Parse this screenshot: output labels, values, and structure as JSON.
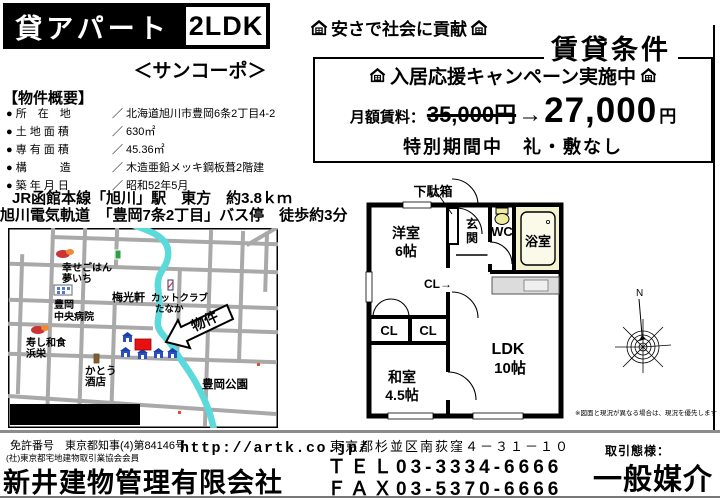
{
  "header": {
    "banner": "貸アパート",
    "unit_type": "2LDK",
    "building_name": "＜サンコーポ＞",
    "slogan": "安さで社会に貢献",
    "conditions_title": "賃貸条件"
  },
  "overview": {
    "section_title": "【物件概要】",
    "rows": [
      {
        "label": "● 所　在　地",
        "value": "／ 北海道旭川市豊岡6条2丁目4-2"
      },
      {
        "label": "● 土 地 面 積",
        "value": "／ 630㎡"
      },
      {
        "label": "● 専 有 面 積",
        "value": "／ 45.36㎡"
      },
      {
        "label": "● 構　　　造",
        "value": "／ 木造亜鉛メッキ鋼板葺2階建"
      },
      {
        "label": "● 築 年 月 日",
        "value": "／ 昭和52年5月"
      }
    ],
    "access_train": "JR函館本線「旭川」駅　東方　約3.8ｋｍ",
    "access_bus": "旭川電気軌道　「豊岡7条2丁目」バス停　徒歩約3分"
  },
  "campaign": {
    "headline": "入居応援キャンペーン実施中",
    "rent_label": "月額賃料：",
    "old_price": "35,000円",
    "arrow": "→",
    "new_price": "27,000",
    "price_unit": "円",
    "special_note": "特別期間中　礼・敷なし"
  },
  "floorplan": {
    "shoe_cabinet": "下駄箱",
    "western_room_line1": "洋室",
    "western_room_line2": "6帖",
    "entrance_char1": "玄",
    "entrance_char2": "関",
    "wc": "WC",
    "bath": "浴室",
    "closet_arrow": "CL→",
    "closet1": "CL",
    "closet2": "CL",
    "ldk_line1": "LDK",
    "ldk_line2": "10帖",
    "japanese_room_line1": "和室",
    "japanese_room_line2": "4.5帖",
    "compass_north": "N",
    "disclaimer": "※図面と現況が異なる場合は、現況を優先します"
  },
  "map": {
    "caption": "現地案内図",
    "property_label": "物件",
    "poi": {
      "restaurant1_line1": "幸せごはん",
      "restaurant1_line2": "夢いち",
      "hospital_line1": "豊岡",
      "hospital_line2": "中央病院",
      "ramen": "梅光軒",
      "salon_line1": "カットクラブ",
      "salon_line2": "たなか",
      "sushi_line1": "寿し和食",
      "sushi_line2": "浜栄",
      "liquor_line1": "かとう",
      "liquor_line2": "酒店",
      "park": "豊岡公園"
    }
  },
  "footer": {
    "license": "免許番号　東京都知事(4)第84146号",
    "association": "(社)東京都宅地建物取引業協会会員",
    "company": "新井建物管理有限会社",
    "url": "http://artk.co.jp/",
    "address": "東京都杉並区南荻窪４－３１－１０",
    "tel": "ＴＥＬ03-3334-6666",
    "fax": "ＦＡＸ03-5370-6666",
    "deal_type_label": "取引態様：",
    "deal_type": "一般媒介"
  },
  "colors": {
    "bath_fill": "#f5f3cf",
    "river": "#5adada",
    "road": "#a9a9a9",
    "property_red": "#e81010",
    "house_blue": "#2b4fc0"
  }
}
